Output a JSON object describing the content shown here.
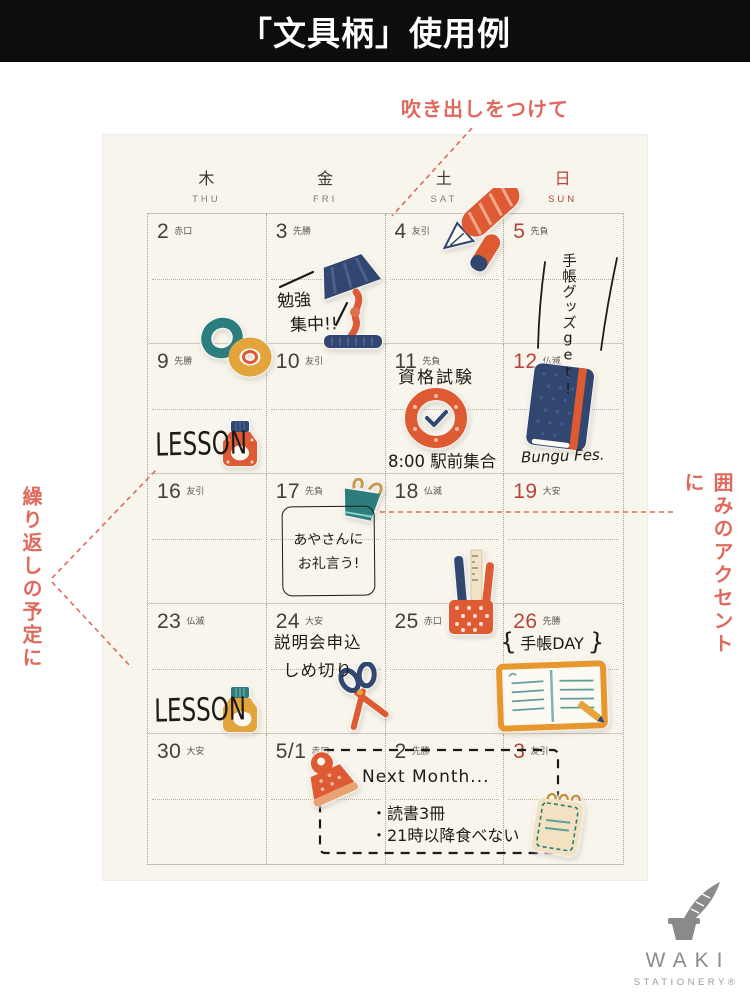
{
  "colors": {
    "banner_bg": "#0d0d0d",
    "paper": "#f8f5ec",
    "annotation": "#e0695e",
    "sunday": "#b5443a",
    "ink": "#3d372e",
    "navy": "#32476f",
    "orange": "#dd5a32",
    "teal": "#2b7d7e",
    "mustard": "#e3a43c",
    "logo_gray": "#8a8a8a"
  },
  "banner": {
    "title": "「文具柄」使用例"
  },
  "annotations": {
    "top": "吹き出しをつけて",
    "left": "繰り返しの予定に",
    "right": "囲みのアクセントに"
  },
  "calendar": {
    "weekdays": [
      {
        "kanji": "木",
        "en": "THU"
      },
      {
        "kanji": "金",
        "en": "FRI"
      },
      {
        "kanji": "土",
        "en": "SAT"
      },
      {
        "kanji": "日",
        "en": "SUN"
      }
    ],
    "cells": [
      {
        "date": "2",
        "rokuyo": "赤口"
      },
      {
        "date": "3",
        "rokuyo": "先勝"
      },
      {
        "date": "4",
        "rokuyo": "友引"
      },
      {
        "date": "5",
        "rokuyo": "先負"
      },
      {
        "date": "9",
        "rokuyo": "先勝"
      },
      {
        "date": "10",
        "rokuyo": "友引"
      },
      {
        "date": "11",
        "rokuyo": "先負"
      },
      {
        "date": "12",
        "rokuyo": "仏滅"
      },
      {
        "date": "16",
        "rokuyo": "友引"
      },
      {
        "date": "17",
        "rokuyo": "先負"
      },
      {
        "date": "18",
        "rokuyo": "仏滅"
      },
      {
        "date": "19",
        "rokuyo": "大安"
      },
      {
        "date": "23",
        "rokuyo": "仏滅"
      },
      {
        "date": "24",
        "rokuyo": "大安"
      },
      {
        "date": "25",
        "rokuyo": "赤口"
      },
      {
        "date": "26",
        "rokuyo": "先勝"
      },
      {
        "date": "30",
        "rokuyo": "大安"
      },
      {
        "date": "5/1",
        "rokuyo": "赤口"
      },
      {
        "date": "2",
        "rokuyo": "先勝"
      },
      {
        "date": "3",
        "rokuyo": "友引"
      }
    ]
  },
  "notes": {
    "study_line1": "勉強",
    "study_line2": "集中!!",
    "techo_goods": "手帳グッズget!",
    "lesson_1": "LESSON",
    "exam": "資格試験",
    "meetup": "8:00 駅前集合",
    "bungu_fes": "Bungu Fes.",
    "thanks_line1": "あやさんに",
    "thanks_line2": "お礼言う!",
    "lesson_2": "LESSON",
    "deadline_line1": "説明会申込",
    "deadline_line2": "しめ切り",
    "techo_day_open": "{",
    "techo_day": "手帳DAY",
    "techo_day_close": "}",
    "next_month": "Next Month...",
    "todo_1": "・読書3冊",
    "todo_2": "・21時以降食べない"
  },
  "sticker_names": [
    "fountain-pen-sticker",
    "desk-lamp-sticker",
    "washi-tape-sticker",
    "ink-bottle-navy-sticker",
    "clock-sticker",
    "notebook-sticker",
    "binder-clip-sticker",
    "pen-stand-sticker",
    "ink-bottle-yellow-sticker",
    "scissors-sticker",
    "open-notebook-sticker",
    "paper-clip-sticker",
    "memo-pad-sticker",
    "quill-inkwell-logo-icon"
  ],
  "logo": {
    "name": "WAKI",
    "sub": "STATIONERY®"
  }
}
